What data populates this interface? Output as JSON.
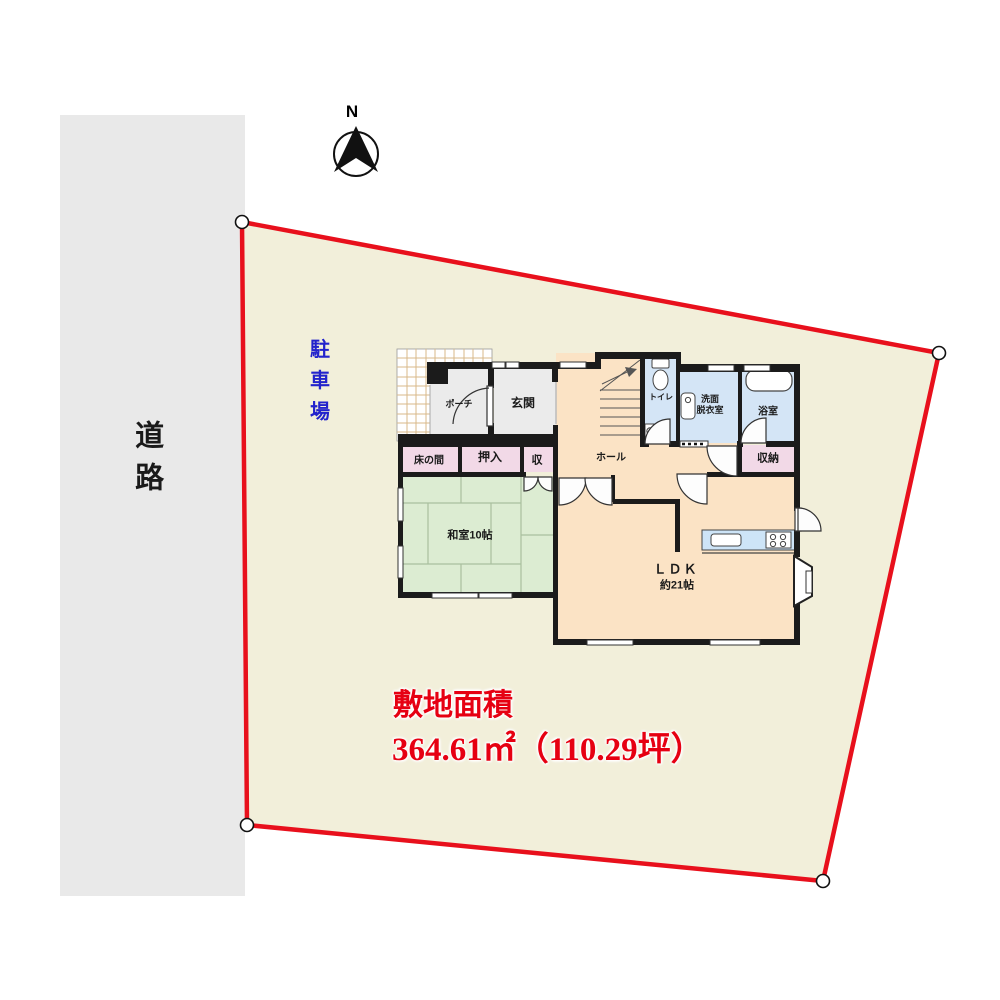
{
  "compass": {
    "label": "N"
  },
  "road": {
    "label": "道路"
  },
  "site": {
    "parking_label": "駐車場",
    "area_title": "敷地面積",
    "area_value": "364.61㎡（110.29坪）"
  },
  "floorplan": {
    "porch": "ポーチ",
    "entrance": "玄関",
    "toilet": "トイレ",
    "washroom_line1": "洗面",
    "washroom_line2": "脱衣室",
    "bathroom": "浴室",
    "storage_right": "収納",
    "tokonoma": "床の間",
    "oshiire": "押入",
    "storage_small": "収",
    "washitsu": "和室10帖",
    "hall": "ホール",
    "ldk": "ＬＤＫ",
    "ldk_size": "約21帖"
  },
  "colors": {
    "boundary_red": "#e8101c",
    "lot_fill": "#f2efda",
    "road_fill": "#e9e9e9",
    "parking_text": "#2323cc",
    "area_text": "#e60012",
    "floor_peach": "#fbe3c5",
    "entry_gray": "#ebebeb",
    "wet_blue": "#d4e5f6",
    "closet_pink": "#f2d9e7",
    "tatami_green": "#dcecd2",
    "wall_black": "#1b1b1b"
  }
}
